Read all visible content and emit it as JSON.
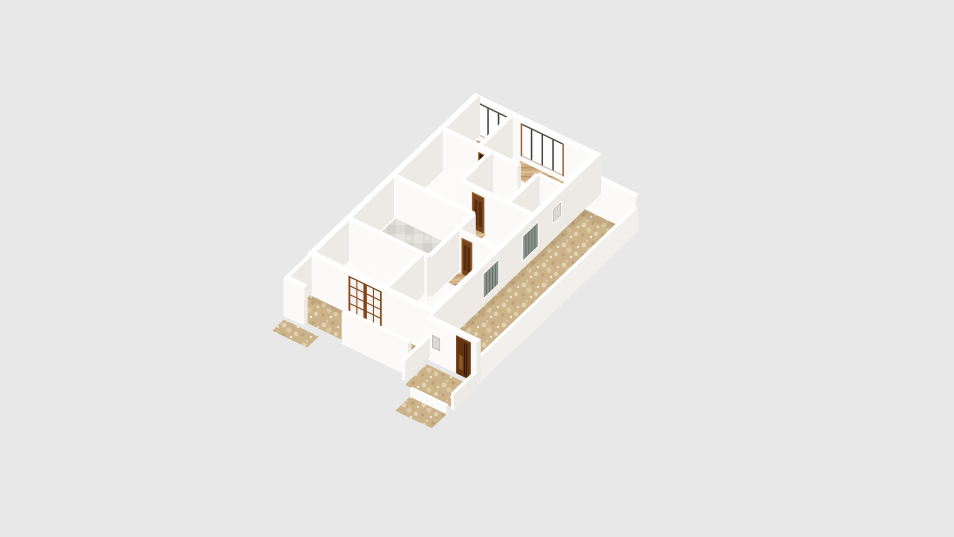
{
  "app": {
    "view_label": "3d-floorplan-render",
    "has_text": false
  },
  "canvas": {
    "width": 954,
    "height": 537,
    "background": "#e8e8e8"
  },
  "projection": {
    "x0": 475,
    "y0": 133,
    "ux": 0.83,
    "uy": 0.4,
    "vx": -0.68,
    "vy": 0.65,
    "wall_height": 40
  },
  "palette": {
    "background": "#e8e8e8",
    "wall_lit": "#fbfaf8",
    "wall_shade": "#edeae6",
    "wall_top": "#ffffff",
    "floor_base": "#fcfbfa",
    "tile_base": "#cdb389",
    "tile_light": "#e0d2b2",
    "tile_light2": "#d9c9a4",
    "tile_dark": "#bca176",
    "tile_white": "#efe8d8",
    "marble_base": "#dedbd6",
    "marble_light": "#e6e4e0",
    "marble_dark": "#d4d1cc",
    "wood_base": "#cfad81",
    "wood_light": "#dbbf97",
    "wood_dark": "#bb9569",
    "door_frame": "#935f2e",
    "door_leaf": "#76431b",
    "door_panel": "#552c0d",
    "dark_open": "#2b1606",
    "dark_frame": "#8a5a2e",
    "french_frame": "#7c431c",
    "french_leaf": "#8a4e22",
    "pane": "#f6f4f1",
    "entry_frame": "#7a4a22",
    "entry_leaf": "#63350f",
    "entry_dark": "#201106",
    "entry_light": "#8a5a2a",
    "shutter_fill": "#8b948d",
    "shutter_line": "#4f5a52",
    "glass": "#fdfdfd",
    "post": "#3c3b39",
    "jamb": "#9a6434",
    "rail_top": "#55524e",
    "sill": "#cabfae",
    "white_win_inner": "#dcd9d4",
    "white_win_line": "#b5afa6",
    "shadow_soft": "rgba(146,120,88,0.18)"
  },
  "floors": [
    {
      "name": "house-floor",
      "u": [
        6,
        149
      ],
      "v": [
        6,
        242
      ],
      "fill": "#fcfbfa"
    },
    {
      "name": "bedroom1-wood-floor",
      "u": [
        8,
        46
      ],
      "v": [
        6,
        20
      ],
      "fill": "wood"
    },
    {
      "name": "bedroom2-wood-floor",
      "u": [
        60,
        114
      ],
      "v": [
        6,
        26
      ],
      "fill": "wood"
    },
    {
      "name": "hall-wood-floor",
      "u": [
        96,
        118
      ],
      "v": [
        44,
        62
      ],
      "fill": "wood"
    },
    {
      "name": "door-threshold-1",
      "u": [
        48,
        64
      ],
      "v": [
        52,
        66
      ],
      "fill": "wood"
    },
    {
      "name": "door-threshold-2",
      "u": [
        74,
        94
      ],
      "v": [
        96,
        112
      ],
      "fill": "wood"
    },
    {
      "name": "door-threshold-3",
      "u": [
        104,
        123
      ],
      "v": [
        148,
        166
      ],
      "fill": "wood"
    },
    {
      "name": "kitchen-marble-floor",
      "u": [
        8,
        100
      ],
      "v": [
        124,
        190
      ],
      "fill": "marble"
    },
    {
      "name": "terrace-tile-floor",
      "u": [
        150,
        211
      ],
      "v": [
        24,
        254
      ],
      "fill": "tan"
    },
    {
      "name": "veranda-tile-floor",
      "u": [
        0,
        150
      ],
      "v": [
        245,
        277
      ],
      "fill": "tan"
    },
    {
      "name": "entry-stoop-floor",
      "u": [
        150,
        207
      ],
      "v": [
        254,
        286
      ],
      "fill": "tan",
      "dy": 6
    },
    {
      "name": "entry-step-floor",
      "u": [
        158,
        202
      ],
      "v": [
        286,
        310
      ],
      "fill": "tan",
      "dy": 13
    },
    {
      "name": "side-ground-tile",
      "u": [
        0,
        42
      ],
      "v": [
        281,
        298
      ],
      "fill": "tan",
      "dy": 4
    }
  ],
  "shadows": [
    {
      "name": "shadow-terrace-side",
      "u": [
        150,
        158
      ],
      "v": [
        24,
        252
      ]
    },
    {
      "name": "shadow-terrace-back",
      "u": [
        152,
        211
      ],
      "v": [
        24,
        32
      ]
    },
    {
      "name": "shadow-veranda",
      "u": [
        0,
        150
      ],
      "v": [
        245,
        252
      ]
    }
  ],
  "walls": [
    {
      "name": "back-wall",
      "axis": "u",
      "at": 3,
      "from": 0,
      "to": 152,
      "h": 40,
      "t": 6,
      "decor": [
        {
          "type": "glass_window",
          "from": 8,
          "to": 46,
          "z1": 5,
          "z2": 38,
          "posts": 2
        },
        {
          "type": "glass_window",
          "from": 60,
          "to": 112,
          "z1": 5,
          "z2": 38,
          "posts": 3
        }
      ]
    },
    {
      "name": "left-wall",
      "axis": "v",
      "at": 3,
      "from": 0,
      "to": 245,
      "h": 40,
      "t": 6
    },
    {
      "name": "bedroom-divider-wall",
      "axis": "v",
      "at": 48,
      "from": 6,
      "to": 52,
      "h": 40,
      "t": 5
    },
    {
      "name": "corridor-back-wall-left",
      "axis": "u",
      "at": 52,
      "from": 6,
      "to": 48,
      "h": 40,
      "t": 5
    },
    {
      "name": "corridor-doorway-wall",
      "axis": "u",
      "at": 52,
      "from": 48,
      "to": 62,
      "h": 40,
      "t": 5,
      "decor": [
        {
          "type": "dark_opening",
          "from": 48.5,
          "to": 61.5,
          "z2": 35
        }
      ]
    },
    {
      "name": "corridor-back-wall-mid",
      "axis": "u",
      "at": 52,
      "from": 62,
      "to": 96,
      "h": 40,
      "t": 5
    },
    {
      "name": "terrace-back-wall",
      "axis": "u",
      "at": 21,
      "from": 152,
      "to": 213,
      "h": 36,
      "t": 5
    },
    {
      "name": "corridor-back-wall-right",
      "axis": "u",
      "at": 52,
      "from": 118,
      "to": 152,
      "h": 40,
      "t": 5
    },
    {
      "name": "hall-left-wall",
      "axis": "v",
      "at": 62,
      "from": 52,
      "to": 96,
      "h": 40,
      "t": 5
    },
    {
      "name": "hall-right-wall",
      "axis": "v",
      "at": 118,
      "from": 52,
      "to": 96,
      "h": 40,
      "t": 5
    },
    {
      "name": "mid-wall-left",
      "axis": "u",
      "at": 96,
      "from": 62,
      "to": 76,
      "h": 40,
      "t": 5
    },
    {
      "name": "interior-door-1-wall",
      "axis": "u",
      "at": 96,
      "from": 76,
      "to": 93,
      "h": 40,
      "t": 5,
      "decor": [
        {
          "type": "panel_door",
          "from": 77,
          "to": 92
        }
      ]
    },
    {
      "name": "mid-wall-right",
      "axis": "u",
      "at": 96,
      "from": 93,
      "to": 152,
      "h": 40,
      "t": 5
    },
    {
      "name": "kitchen-back-wall",
      "axis": "u",
      "at": 124,
      "from": 6,
      "to": 100,
      "h": 40,
      "t": 5
    },
    {
      "name": "kitchen-right-wall-upper",
      "axis": "v",
      "at": 100,
      "from": 124,
      "to": 148,
      "h": 40,
      "t": 5
    },
    {
      "name": "bedroom3-wall-seg",
      "axis": "u",
      "at": 148,
      "from": 100,
      "to": 106,
      "h": 40,
      "t": 5
    },
    {
      "name": "interior-door-2-wall",
      "axis": "u",
      "at": 148,
      "from": 106,
      "to": 121,
      "h": 40,
      "t": 5,
      "decor": [
        {
          "type": "panel_door",
          "from": 107,
          "to": 120
        }
      ]
    },
    {
      "name": "bedroom3-wall-seg-2",
      "axis": "u",
      "at": 148,
      "from": 121,
      "to": 152,
      "h": 40,
      "t": 5
    },
    {
      "name": "kitchen-right-wall-lower",
      "axis": "v",
      "at": 100,
      "from": 148,
      "to": 190,
      "h": 40,
      "t": 5
    },
    {
      "name": "kitchen-front-wall",
      "axis": "u",
      "at": 190,
      "from": 6,
      "to": 100,
      "h": 40,
      "t": 5
    },
    {
      "name": "right-wall",
      "axis": "v",
      "at": 149,
      "from": 0,
      "to": 245,
      "h": 40,
      "t": 6,
      "decor": [
        {
          "type": "white_window",
          "from": 58,
          "to": 72,
          "z1": 16,
          "z2": 31
        },
        {
          "type": "shutter_window",
          "from": 92,
          "to": 116,
          "z1": 7,
          "z2": 33
        },
        {
          "type": "shutter_window",
          "from": 150,
          "to": 174,
          "z1": 7,
          "z2": 33
        }
      ]
    },
    {
      "name": "front-hall-wall",
      "axis": "v",
      "at": 92,
      "from": 190,
      "to": 242,
      "h": 40,
      "t": 5
    },
    {
      "name": "front-wall",
      "axis": "u",
      "at": 244,
      "from": 0,
      "to": 152,
      "h": 40,
      "t": 6,
      "decor": [
        {
          "type": "french_door",
          "from": 50,
          "to": 90
        }
      ]
    },
    {
      "name": "veranda-left-wall",
      "axis": "v",
      "at": 2,
      "from": 245,
      "to": 281,
      "h": 38,
      "t": 4
    },
    {
      "name": "veranda-outer-wall-left",
      "axis": "u",
      "at": 279,
      "from": 0,
      "to": 25,
      "h": 38,
      "t": 5
    },
    {
      "name": "veranda-outer-wall-right",
      "axis": "u",
      "at": 279,
      "from": 70,
      "to": 150,
      "h": 32,
      "t": 5
    },
    {
      "name": "terrace-railing",
      "axis": "v",
      "at": 211,
      "from": 21,
      "to": 254,
      "h": 24,
      "t": 4,
      "colors": {
        "lit": "#fdfdfc",
        "shade": "#f2f0ed",
        "top": "#ffffff"
      }
    },
    {
      "name": "porch-wall",
      "axis": "u",
      "at": 252,
      "from": 150,
      "to": 211,
      "h": 40,
      "t": 6,
      "decor": [
        {
          "type": "white_window",
          "from": 156,
          "to": 168,
          "z1": 13,
          "z2": 28
        },
        {
          "type": "entry_door",
          "from": 186,
          "to": 204
        }
      ]
    },
    {
      "name": "stoop-left-wall",
      "axis": "v",
      "at": 150,
      "from": 252,
      "to": 288,
      "h": 20,
      "t": 4
    },
    {
      "name": "stoop-right-railing",
      "axis": "v",
      "at": 209,
      "from": 254,
      "to": 288,
      "h": 16,
      "t": 4,
      "dy": 6
    },
    {
      "name": "stoop-step-riser",
      "axis": "u",
      "at": 287,
      "from": 158,
      "to": 202,
      "h": 8,
      "t": 3,
      "dy": 13
    }
  ]
}
